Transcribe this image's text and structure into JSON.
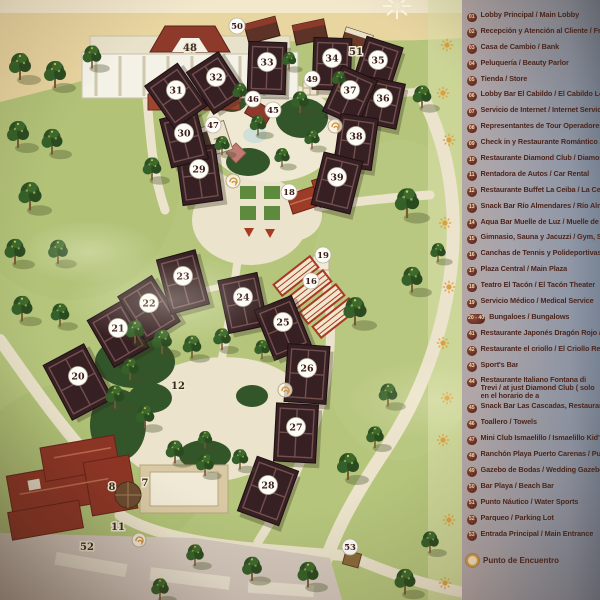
{
  "legend": {
    "items": [
      {
        "num": "01",
        "label": "Lobby Principal / Main Lobby"
      },
      {
        "num": "02",
        "label": "Recepción y Atención al Cliente / Front De"
      },
      {
        "num": "03",
        "label": "Casa de Cambio / Bank"
      },
      {
        "num": "04",
        "label": "Peluquería / Beauty Parlor"
      },
      {
        "num": "05",
        "label": "Tienda / Store"
      },
      {
        "num": "06",
        "label": "Lobby Bar El Cabildo / El Cabildo Lobby Ba"
      },
      {
        "num": "07",
        "label": "Servicio de Internet / Internet Service"
      },
      {
        "num": "08",
        "label": "Representantes de Tour Operadores / Tour"
      },
      {
        "num": "09",
        "label": "Check in y Restaurante Romántico / Check"
      },
      {
        "num": "10",
        "label": "Restaurante Diamond Club / Diamon Club"
      },
      {
        "num": "11",
        "label": "Rentadora de Autos / Car Rental"
      },
      {
        "num": "12",
        "label": "Restaurante Buffet La Ceiba / La Ceiba Buf"
      },
      {
        "num": "13",
        "label": "Snack Bar Río Almendares / Río Almendar"
      },
      {
        "num": "14",
        "label": "Aqua Bar Muelle de Luz / Muelle de Luz Aq"
      },
      {
        "num": "15",
        "label": "Gimnasio, Sauna y Jacuzzi / Gym, Sauna a"
      },
      {
        "num": "16",
        "label": "Canchas de Tennis y Polideportivas / Tenn"
      },
      {
        "num": "17",
        "label": "Plaza Central / Main Plaza"
      },
      {
        "num": "18",
        "label": "Teatro El Tacón / El Tacón Theater"
      },
      {
        "num": "19",
        "label": "Servicio Médico / Medical Service"
      },
      {
        "num": "20 - 40",
        "label": "Bungaloes / Bungalows"
      },
      {
        "num": "41",
        "label": "Restaurante Japonés Dragón Rojo / Dragó"
      },
      {
        "num": "42",
        "label": "Restaurante el criollo / El Criollo Restaura"
      },
      {
        "num": "43",
        "label": "Sport's Bar"
      },
      {
        "num": "44",
        "label": "Restaurante Italiano Fontana di Trevi / at just Diamond Club ( solo en el horario de a",
        "two_line": true
      },
      {
        "num": "45",
        "label": "Snack Bar Las Cascadas, Restaurante Mex"
      },
      {
        "num": "46",
        "label": "Toallero / Towels"
      },
      {
        "num": "47",
        "label": "Mini Club Ismaelillo / Ismaelillo Kid's Club"
      },
      {
        "num": "48",
        "label": "Ranchón Playa Puerto Carenas / Puerto Ca"
      },
      {
        "num": "49",
        "label": "Gazebo de Bodas / Wedding Gazebo"
      },
      {
        "num": "50",
        "label": "Bar Playa / Beach Bar"
      },
      {
        "num": "51",
        "label": "Punto Náutico / Water Sports"
      },
      {
        "num": "52",
        "label": "Parqueo / Parking Lot"
      },
      {
        "num": "53",
        "label": "Entrada Principal / Main Entrance"
      }
    ],
    "punto_label": "Punto de Encuentro"
  },
  "map": {
    "markers": [
      {
        "num": "50",
        "x": 237,
        "y": 26,
        "k": "s"
      },
      {
        "num": "48",
        "x": 190,
        "y": 48,
        "k": "t"
      },
      {
        "num": "51",
        "x": 356,
        "y": 52,
        "k": "t"
      },
      {
        "num": "33",
        "x": 267,
        "y": 62,
        "k": "b"
      },
      {
        "num": "34",
        "x": 332,
        "y": 58,
        "k": "b"
      },
      {
        "num": "35",
        "x": 378,
        "y": 60,
        "k": "b"
      },
      {
        "num": "32",
        "x": 216,
        "y": 77,
        "k": "b"
      },
      {
        "num": "49",
        "x": 312,
        "y": 79,
        "k": "s"
      },
      {
        "num": "31",
        "x": 176,
        "y": 90,
        "k": "b"
      },
      {
        "num": "37",
        "x": 350,
        "y": 90,
        "k": "b"
      },
      {
        "num": "36",
        "x": 383,
        "y": 98,
        "k": "b"
      },
      {
        "num": "46",
        "x": 253,
        "y": 99,
        "k": "s"
      },
      {
        "num": "45",
        "x": 273,
        "y": 110,
        "k": "s"
      },
      {
        "num": "47",
        "x": 213,
        "y": 125,
        "k": "s"
      },
      {
        "num": "30",
        "x": 184,
        "y": 133,
        "k": "b"
      },
      {
        "num": "38",
        "x": 356,
        "y": 136,
        "k": "b"
      },
      {
        "num": "29",
        "x": 199,
        "y": 169,
        "k": "b"
      },
      {
        "num": "39",
        "x": 337,
        "y": 177,
        "k": "b"
      },
      {
        "num": "18",
        "x": 289,
        "y": 192,
        "k": "s"
      },
      {
        "num": "19",
        "x": 323,
        "y": 255,
        "k": "s"
      },
      {
        "num": "23",
        "x": 183,
        "y": 276,
        "k": "b"
      },
      {
        "num": "16",
        "x": 311,
        "y": 281,
        "k": "s"
      },
      {
        "num": "24",
        "x": 243,
        "y": 297,
        "k": "b"
      },
      {
        "num": "22",
        "x": 149,
        "y": 303,
        "k": "b"
      },
      {
        "num": "25",
        "x": 283,
        "y": 322,
        "k": "b"
      },
      {
        "num": "21",
        "x": 118,
        "y": 328,
        "k": "b"
      },
      {
        "num": "26",
        "x": 307,
        "y": 368,
        "k": "b"
      },
      {
        "num": "20",
        "x": 78,
        "y": 376,
        "k": "b"
      },
      {
        "num": "12",
        "x": 178,
        "y": 386,
        "k": "t"
      },
      {
        "num": "27",
        "x": 296,
        "y": 427,
        "k": "b"
      },
      {
        "num": "7",
        "x": 145,
        "y": 483,
        "k": "t"
      },
      {
        "num": "8",
        "x": 112,
        "y": 487,
        "k": "t"
      },
      {
        "num": "28",
        "x": 268,
        "y": 485,
        "k": "b"
      },
      {
        "num": "11",
        "x": 118,
        "y": 527,
        "k": "t"
      },
      {
        "num": "52",
        "x": 87,
        "y": 547,
        "k": "t"
      },
      {
        "num": "53",
        "x": 350,
        "y": 547,
        "k": "s"
      }
    ]
  },
  "colors": {
    "grass": "#b5c67c",
    "sand": "#e8d5a0",
    "path": "#ebe3cb",
    "bungalow_roof": "#372023",
    "lobby_roof": "#8e3525",
    "legend_text": "#4e251d",
    "badge": "#6e2e22",
    "sun_accent": "#dd9f3c"
  }
}
